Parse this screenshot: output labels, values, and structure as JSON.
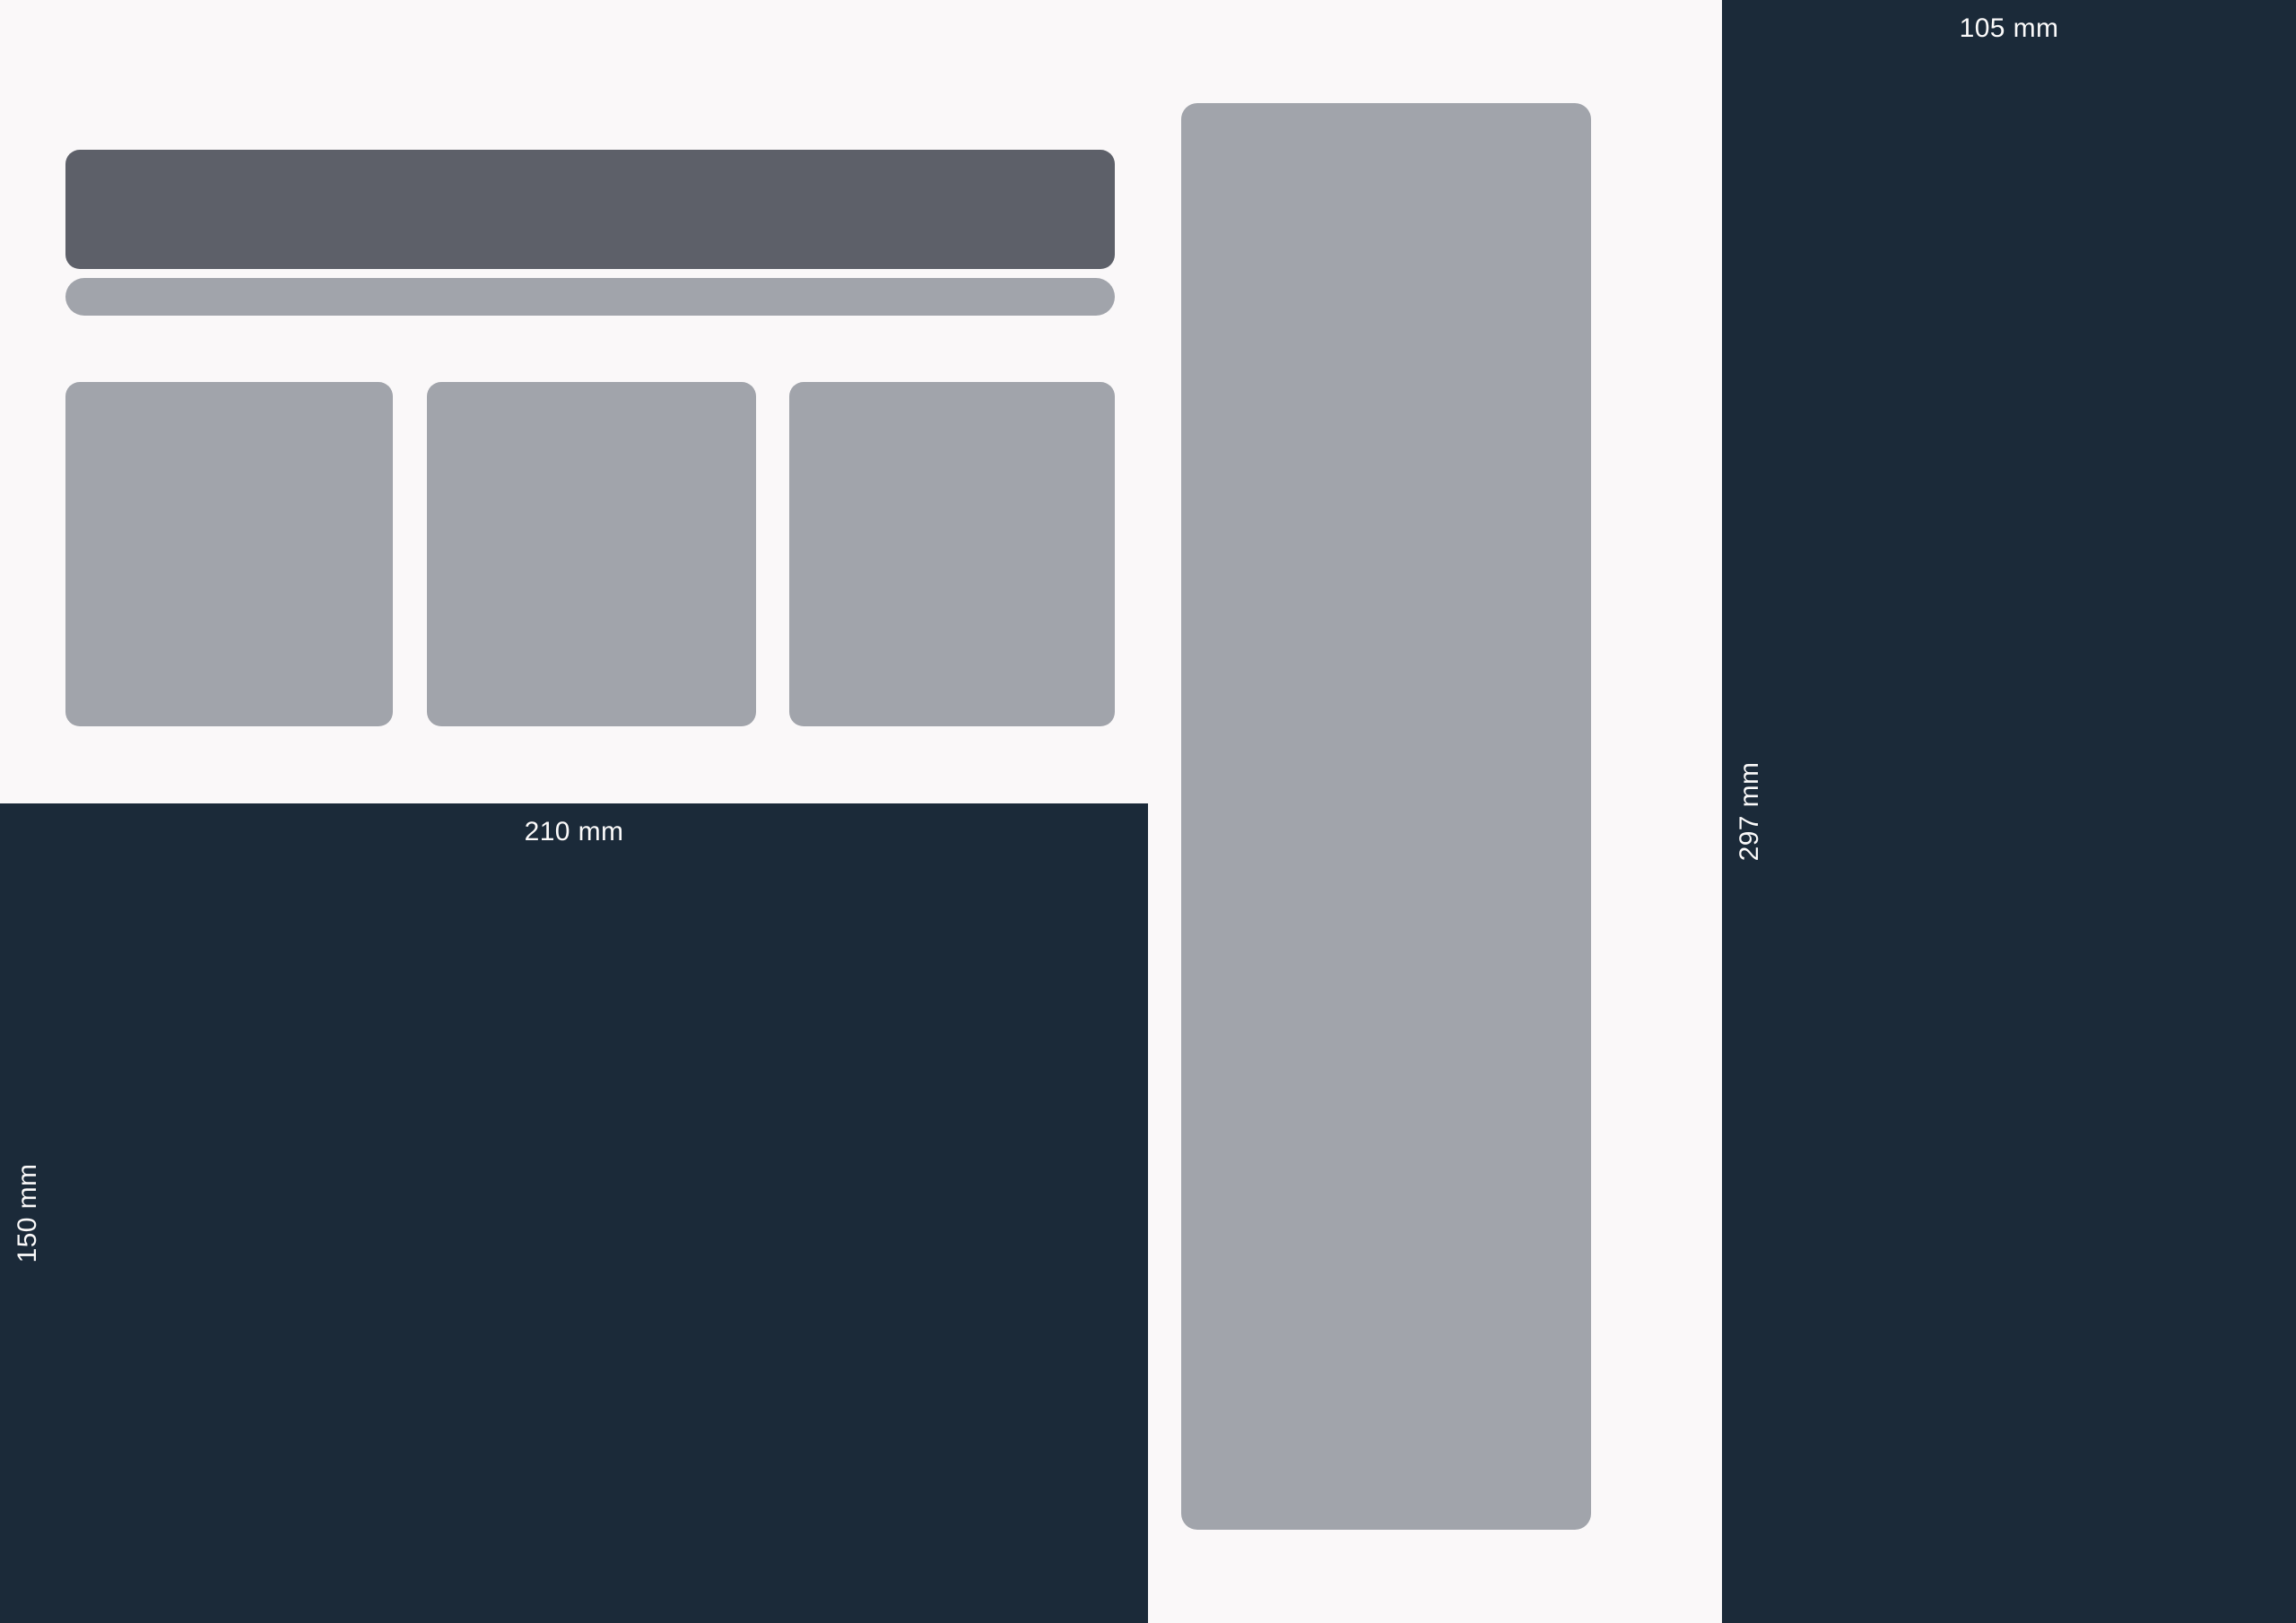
{
  "diagram": {
    "colors": {
      "background": "#faf8f9",
      "panel": "#1b2a39",
      "block": "#a1a4ab",
      "block_dark": "#5d6069",
      "label_text": "#fbfafa"
    },
    "right_panel": {
      "width_label": "105 mm",
      "height_label": "297 mm"
    },
    "bottom_left_panel": {
      "width_label": "210 mm",
      "height_label": "150 mm"
    }
  }
}
